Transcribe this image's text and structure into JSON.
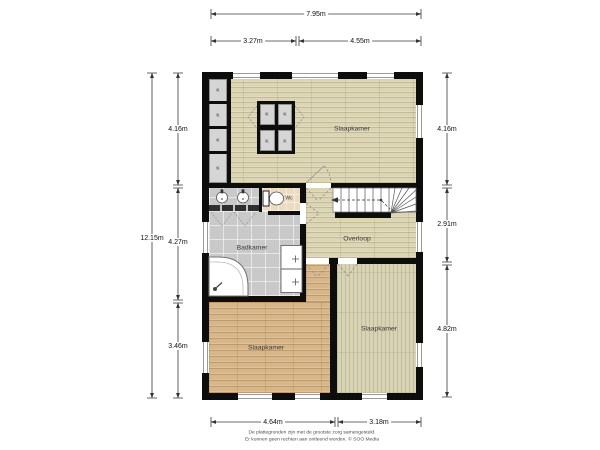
{
  "dimensions": {
    "top_total": "7.95m",
    "top_a": "3.27m",
    "top_b": "4.55m",
    "left_total": "12.15m",
    "left_a": "4.16m",
    "left_b": "4.27m",
    "left_c": "3.46m",
    "right_a": "4.16m",
    "right_b": "2.91m",
    "right_c": "4.82m",
    "bottom_a": "4.64m",
    "bottom_b": "3.18m"
  },
  "rooms": {
    "bedroom_top": "Slaapkamer",
    "wc": "Wc",
    "bathroom": "Badkamer",
    "landing": "Overloop",
    "bedroom_bottom_left": "Slaapkamer",
    "bedroom_bottom_right": "Slaapkamer"
  },
  "closets": {
    "label": "K"
  },
  "footer": {
    "line1": "De plattegronden zijn met de grootste zorg samengesteld.",
    "line2": "Er kunnen geen rechten aan ontleend worden. © SOO Media"
  },
  "colors": {
    "wall": "#0d0d0d",
    "floor_light_wood": "#dcd5b4",
    "floor_tan_wood": "#d7b689",
    "floor_pale_wood": "#d8d3b5",
    "bathroom_tile": "#c9c9c9",
    "wc_floor": "#ebdbc1",
    "closet_fill": "#d5d5d5"
  }
}
